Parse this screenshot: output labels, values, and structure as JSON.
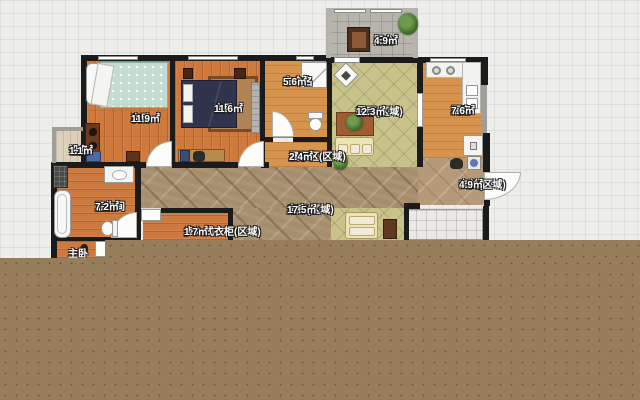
{
  "floor_plan": {
    "rooms": [
      {
        "id": "balcony",
        "name": "阳台",
        "area": "4.9㎡"
      },
      {
        "id": "bedroom-left",
        "name": "次卧",
        "area": "11.9㎡"
      },
      {
        "id": "bedroom-mid",
        "name": "次卧",
        "area": "11.6㎡"
      },
      {
        "id": "unnamed",
        "name": "未命名",
        "area": "5.6㎡"
      },
      {
        "id": "dining",
        "name": "餐厅(区域)",
        "area": "12.3㎡"
      },
      {
        "id": "kitchen",
        "name": "厨房",
        "area": "7.6㎡"
      },
      {
        "id": "equipment",
        "name": "设备",
        "area": "1.1㎡"
      },
      {
        "id": "display-zone",
        "name": "展示区(区域)",
        "area": "2.4㎡"
      },
      {
        "id": "bathroom",
        "name": "卫生间",
        "area": "7.2㎡"
      },
      {
        "id": "closet",
        "name": "步入式衣柜(区域)",
        "area": "1.7㎡"
      },
      {
        "id": "corridor",
        "name": "走廊(区域)",
        "area": "17.5㎡"
      },
      {
        "id": "entry",
        "name": "玄关(区域)",
        "area": "4.9㎡"
      },
      {
        "id": "master-bedroom",
        "name": "主卧",
        "area": ""
      }
    ],
    "colors": {
      "wall": "#1b1b1b",
      "wood_floor": "#cf7a3c",
      "wood_light": "#d6944f",
      "dining_tile": "#c9c28b",
      "corridor_mosaic": "#a68d6d",
      "entry_marble": "#b49a78",
      "balcony_tile": "#b7b4ac",
      "white_tile": "#eae9e6",
      "unrendered_cover": "#967e5c",
      "bed_teal": "#c3dbd0",
      "bed_navy": "#31344e"
    }
  }
}
